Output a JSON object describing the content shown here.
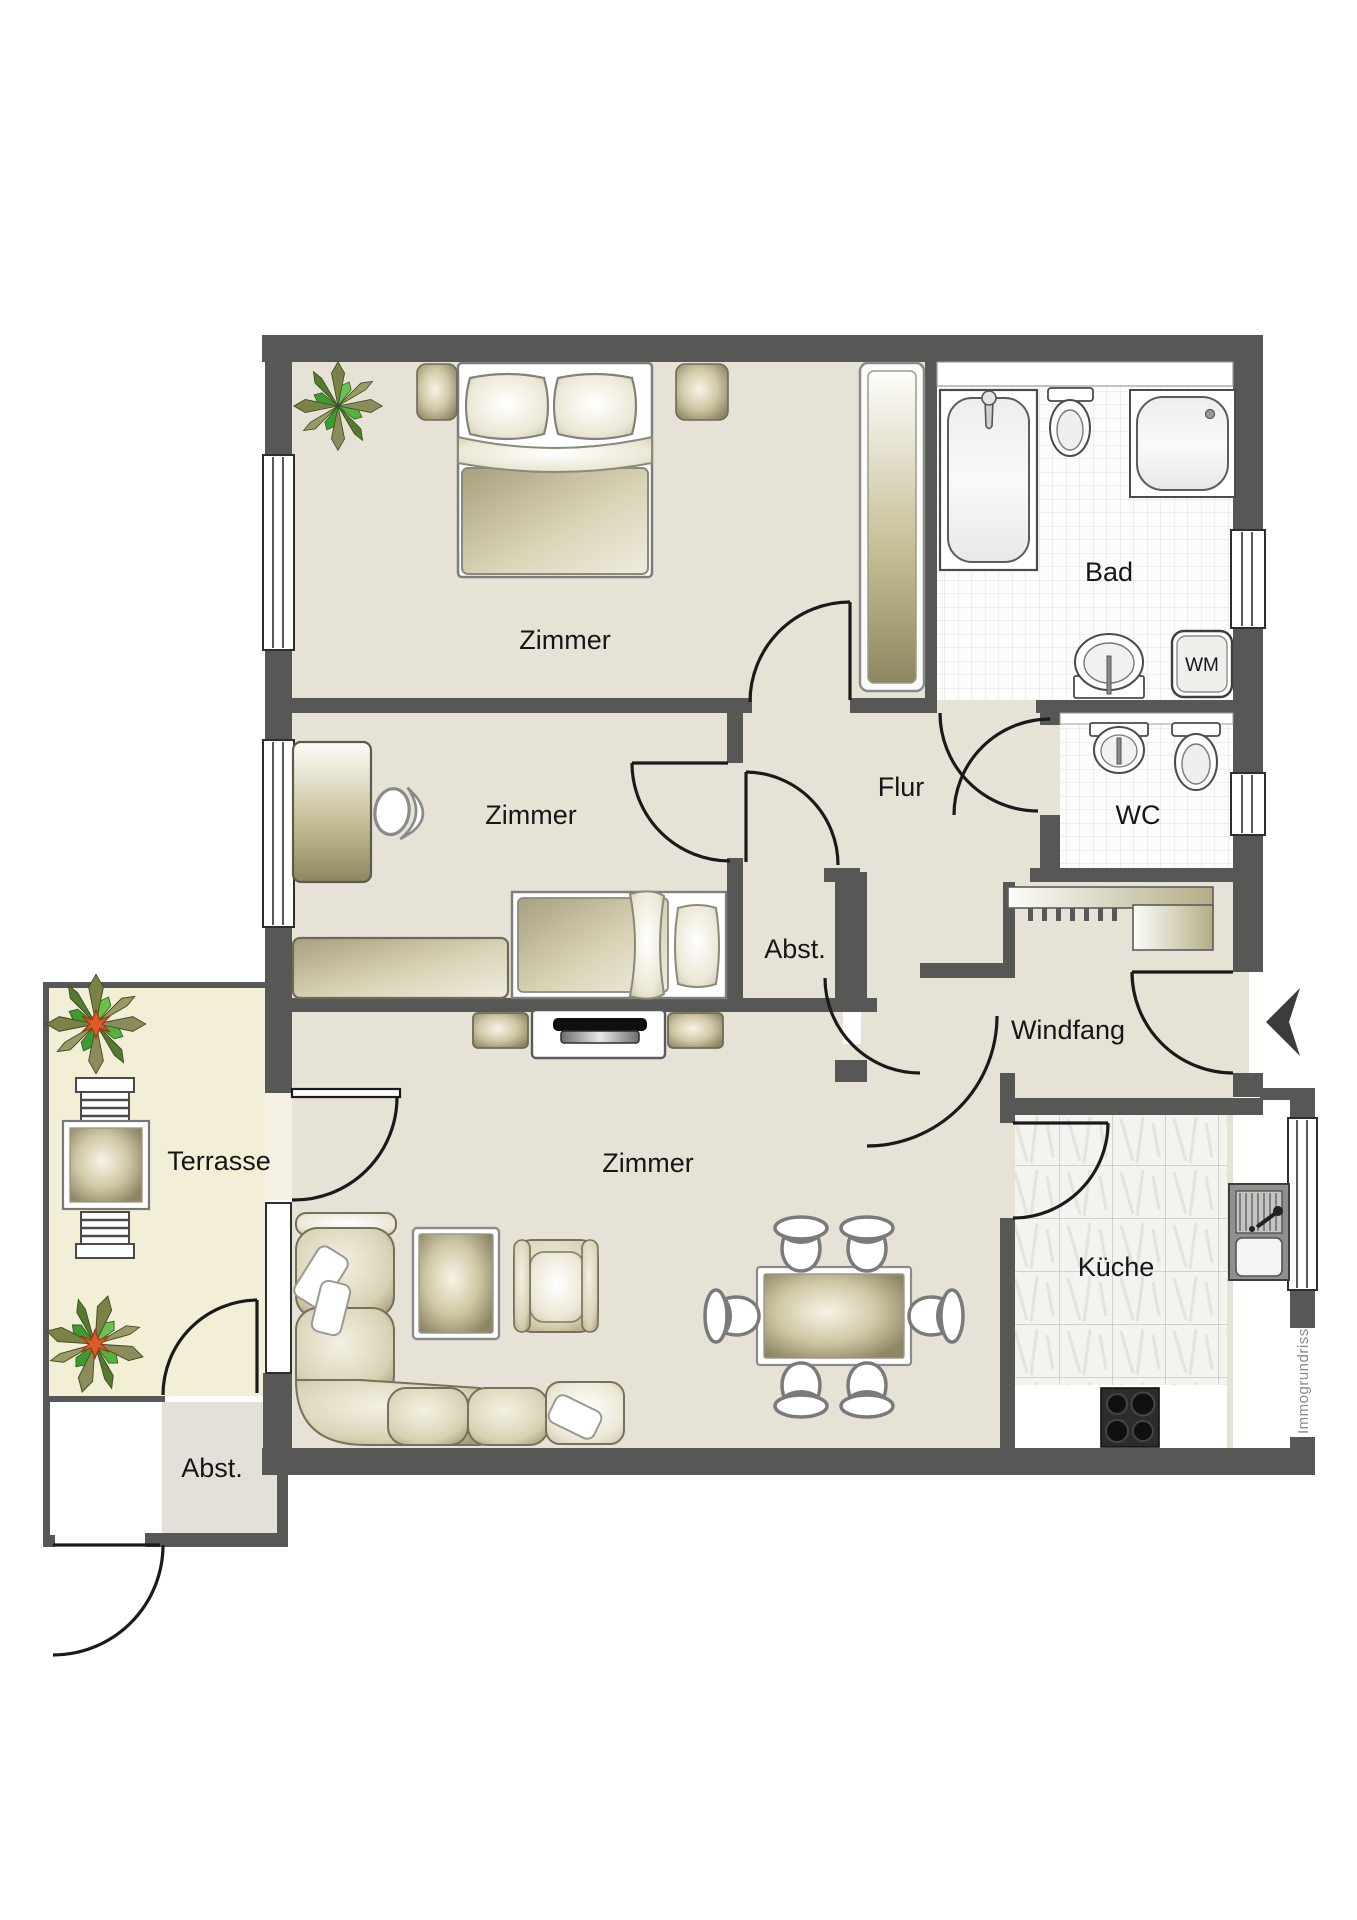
{
  "plan": {
    "type": "apartment-floorplan",
    "watermark": "Immogrundriss"
  },
  "rooms": {
    "bedroom1": {
      "label": "Zimmer"
    },
    "bedroom2": {
      "label": "Zimmer"
    },
    "living": {
      "label": "Zimmer"
    },
    "hallway": {
      "label": "Flur"
    },
    "bath": {
      "label": "Bad"
    },
    "wc": {
      "label": "WC"
    },
    "storage_mid": {
      "label": "Abst."
    },
    "vestibule": {
      "label": "Windfang"
    },
    "kitchen": {
      "label": "Küche"
    },
    "terrace": {
      "label": "Terrasse"
    },
    "storage_bottom": {
      "label": "Abst."
    }
  },
  "appliances": {
    "washing_machine": {
      "label": "WM"
    }
  },
  "colors": {
    "wall": "#575756",
    "floor": "#e6e3d6",
    "terrace_floor": "#f3eed6",
    "storage_floor": "#e2e0d8",
    "tile": "#fbfbfb",
    "kitchen_tile": "#f3f3ef",
    "furniture_olive": "#8e8766",
    "door_swing": "#1a1a1a",
    "entrance_arrow": "#3c3c3b"
  }
}
